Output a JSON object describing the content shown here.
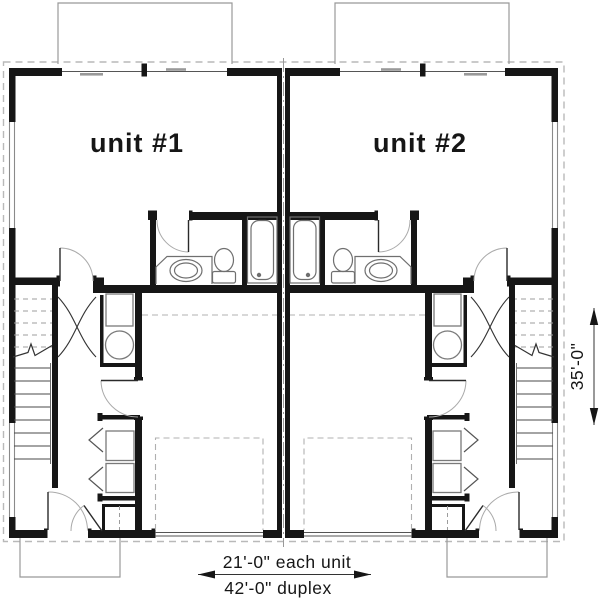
{
  "plan": {
    "type": "duplex-floor-plan",
    "units": [
      {
        "id": "unit-1",
        "label": "unit #1"
      },
      {
        "id": "unit-2",
        "label": "unit #2"
      }
    ],
    "features_per_unit": [
      "deck",
      "living-area",
      "bathroom",
      "bathtub",
      "toilet",
      "sink-counter",
      "stairs",
      "furnace",
      "water-heater",
      "washer",
      "dryer",
      "laundry-closet",
      "entry-closet",
      "one-car-garage",
      "overhead-garage-door",
      "entry-door",
      "front-porch"
    ],
    "shared": [
      "party-wall",
      "roof-overhang-outline"
    ],
    "colors": {
      "background": "#ffffff",
      "wall": "#161616",
      "fixture_line": "#777777",
      "light_line": "#999999",
      "dashed_line": "#b3b3b3",
      "text": "#161616"
    }
  },
  "labels": {
    "unit1": "unit #1",
    "unit2": "unit #2"
  },
  "dims": {
    "each_unit": "21'-0\" each unit",
    "duplex": "42'-0\" duplex",
    "depth": "35'-0\""
  }
}
